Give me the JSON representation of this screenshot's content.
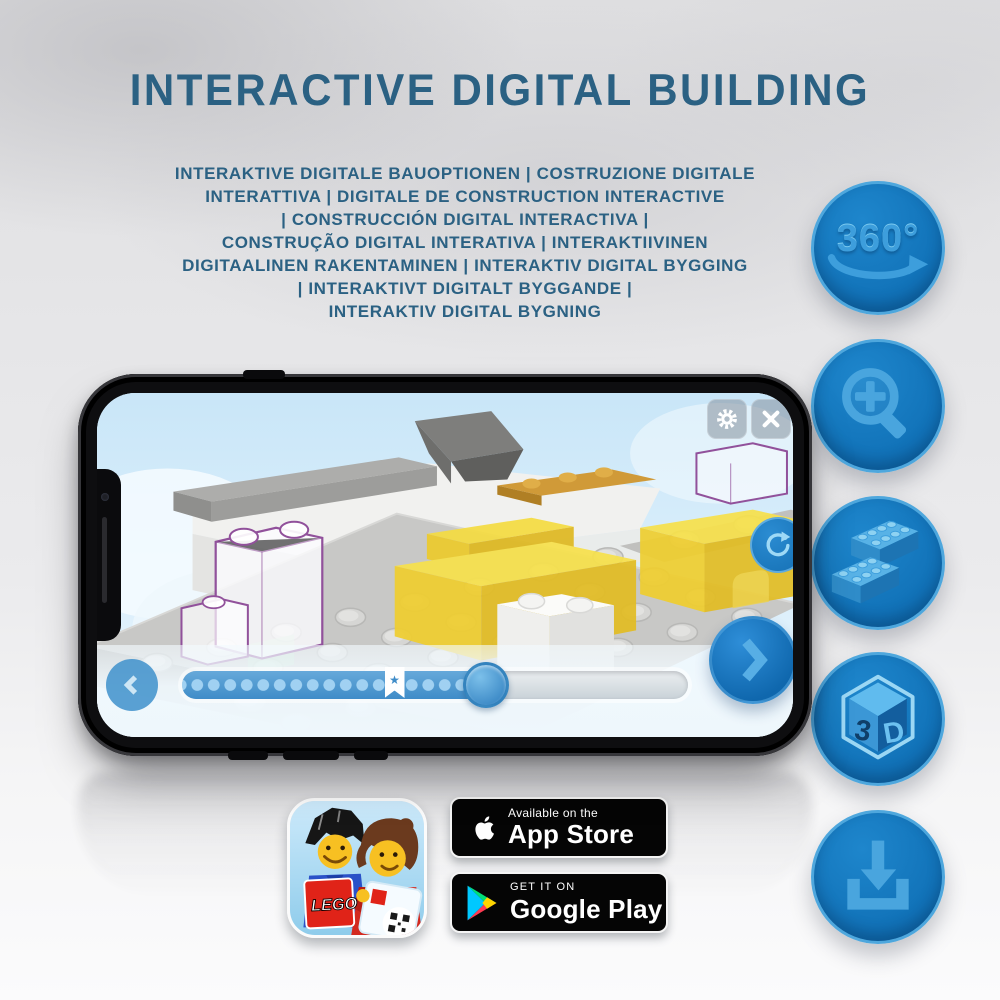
{
  "header": {
    "title": "INTERACTIVE DIGITAL BUILDING",
    "subtitle_lines": [
      "INTERAKTIVE DIGITALE BAUOPTIONEN | COSTRUZIONE DIGITALE",
      "INTERATTIVA | DIGITALE DE CONSTRUCTION INTERACTIVE",
      "| CONSTRUCCIÓN DIGITAL INTERACTIVA |",
      "CONSTRUÇÃO DIGITAL INTERATIVA | INTERAKTIIVINEN",
      "DIGITAALINEN RAKENTAMINEN | INTERAKTIV DIGITAL BYGGING",
      "| INTERAKTIVT DIGITALT BYGGANDE |",
      "INTERAKTIV DIGITAL BYGNING"
    ]
  },
  "feature_icons": {
    "rotation_label": "360°",
    "cube_label_3": "3",
    "cube_label_d": "D"
  },
  "phone": {
    "progress": {
      "fraction": 0.6,
      "bookmark_fraction": 0.42,
      "bookmark_star": "★"
    }
  },
  "badges": {
    "lego_app_logo_text": "LEGO",
    "app_store": {
      "line1": "Available on the",
      "line2": "App Store"
    },
    "google_play": {
      "line1": "GET IT ON",
      "line2": "Google Play"
    }
  },
  "colors": {
    "title_blue": "#2b6183",
    "icon_circle_blue": "#1374ba",
    "icon_glyph_blue": "#49a5de",
    "lego_yellow": "#f2d93c",
    "ghost_outline_purple": "#91519b",
    "badge_black": "#050505"
  }
}
